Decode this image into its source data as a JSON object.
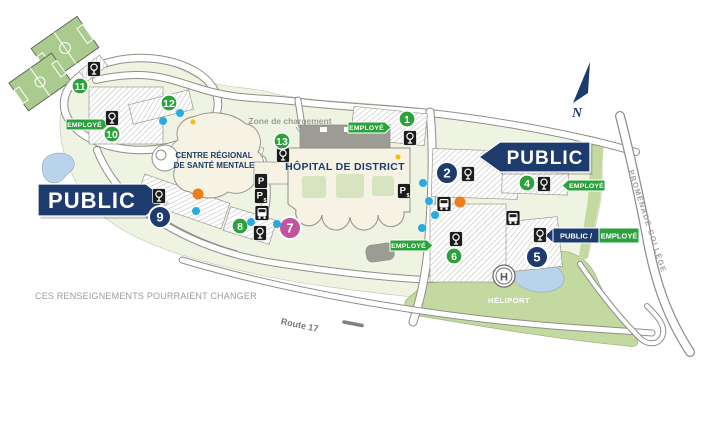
{
  "labels": {
    "hospital": "HÔPITAL DE DISTRICT",
    "mental_health_line1": "CENTRE RÉGIONAL",
    "mental_health_line2": "DE SANTÉ MENTALE",
    "loading_zone": "Zone de chargement",
    "heliport": "HÉLIPORT",
    "heliport_symbol": "H",
    "route_17": "Route 17",
    "promenade_college": "PROMENADE COLLÈGE",
    "disclaimer": "CES RENSEIGNEMENTS POURRAIENT CHANGER",
    "compass_north": "N"
  },
  "banners": [
    {
      "label": "PUBLIC",
      "dir": "right",
      "x": 38,
      "y": 184,
      "w": 108,
      "h": 32,
      "tip": 21,
      "font": 22
    },
    {
      "label": "PUBLIC",
      "dir": "left",
      "x": 500,
      "y": 142,
      "w": 90,
      "h": 30,
      "tip": 21,
      "font": 19
    }
  ],
  "employe_badges": [
    {
      "label": "EMPLOYÉ",
      "x": 66,
      "y": 119,
      "dir": "right"
    },
    {
      "label": "EMPLOYÉ",
      "x": 348,
      "y": 122,
      "dir": "right"
    },
    {
      "label": "EMPLOYÉ",
      "x": 568,
      "y": 180,
      "dir": "left"
    },
    {
      "label": "EMPLOYÉ",
      "x": 390,
      "y": 240,
      "dir": "right"
    }
  ],
  "combo_badge": {
    "public_label": "PUBLIC /",
    "employe_label": "EMPLOYÉ",
    "x": 553,
    "y": 228
  },
  "lot_markers": [
    {
      "number": "1",
      "type": "employe",
      "cx": 407,
      "cy": 119
    },
    {
      "number": "2",
      "type": "public",
      "cx": 447,
      "cy": 173
    },
    {
      "number": "4",
      "type": "employe",
      "cx": 527,
      "cy": 183
    },
    {
      "number": "5",
      "type": "public",
      "cx": 537,
      "cy": 257
    },
    {
      "number": "6",
      "type": "employe",
      "cx": 454,
      "cy": 256
    },
    {
      "number": "7",
      "type": "special",
      "cx": 290,
      "cy": 228
    },
    {
      "number": "8",
      "type": "employe",
      "cx": 240,
      "cy": 226
    },
    {
      "number": "9",
      "type": "public",
      "cx": 160,
      "cy": 217
    },
    {
      "number": "10",
      "type": "employe",
      "cx": 112,
      "cy": 134
    },
    {
      "number": "11",
      "type": "employe",
      "cx": 80,
      "cy": 86
    },
    {
      "number": "12",
      "type": "employe",
      "cx": 169,
      "cy": 103
    },
    {
      "number": "13",
      "type": "employe",
      "cx": 282,
      "cy": 141
    }
  ],
  "icons": {
    "parking_meters": [
      [
        94,
        69
      ],
      [
        112,
        118
      ],
      [
        159,
        196
      ],
      [
        283,
        155
      ],
      [
        260,
        233
      ],
      [
        410,
        138
      ],
      [
        468,
        174
      ],
      [
        544,
        184
      ],
      [
        540,
        235
      ],
      [
        456,
        239
      ]
    ],
    "paid_parking": [
      [
        261,
        196
      ],
      [
        404,
        191
      ]
    ],
    "parking_plain": [
      [
        261,
        181
      ]
    ],
    "bus_stops": [
      [
        262,
        213
      ],
      [
        444,
        204
      ],
      [
        513,
        218
      ]
    ]
  },
  "dots": {
    "blue": [
      [
        163,
        121
      ],
      [
        180,
        113
      ],
      [
        196,
        211
      ],
      [
        251,
        222
      ],
      [
        277,
        224
      ],
      [
        423,
        183
      ],
      [
        429,
        201
      ],
      [
        435,
        215
      ],
      [
        422,
        228
      ]
    ],
    "orange": [
      [
        198,
        194
      ],
      [
        460,
        202
      ]
    ],
    "yellow": [
      [
        193,
        122
      ],
      [
        398,
        157
      ]
    ]
  },
  "colors": {
    "navy": "#1d3c6d",
    "green": "#2ca13c",
    "magenta": "#c1549c",
    "blue_dot": "#29abe2",
    "orange_dot": "#f07d1a",
    "yellow_dot": "#f2c200",
    "icon_black": "#1c1c1c"
  }
}
